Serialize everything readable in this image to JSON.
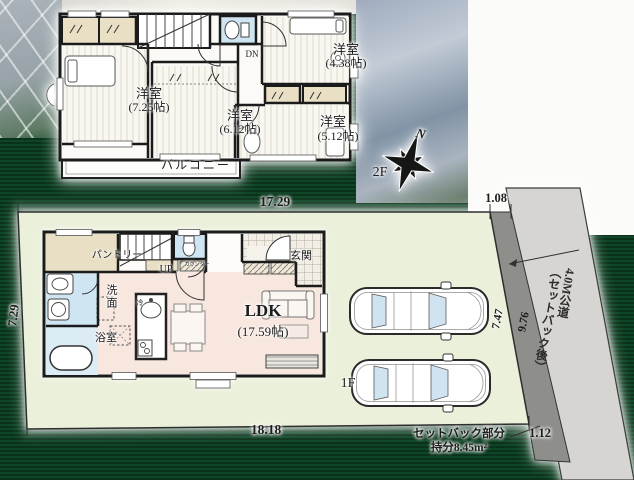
{
  "watermark": "HOUSE",
  "compass": {
    "north_label": "N"
  },
  "floor2": {
    "floor_label": "2F",
    "stair_label": "DN",
    "balcony_label": "バルコニー",
    "room_a_name": "洋室",
    "room_a_size": "(7.25帖)",
    "room_b_name": "洋室",
    "room_b_size": "(6.12帖)",
    "room_c_name": "洋室",
    "room_c_size": "(4.38帖)",
    "room_d_name": "洋室",
    "room_d_size": "(5.12帖)"
  },
  "floor1": {
    "floor_label": "1F",
    "stair_label": "UP",
    "pantry_label": "パントリー",
    "counter_label": "カウンター",
    "entrance_label": "玄関",
    "washroom_label": "洗面",
    "bath_label": "浴室",
    "fridge_label": "冷",
    "ldk_name": "LDK",
    "ldk_size": "(17.59帖)"
  },
  "site": {
    "dim_top_width": "17.29",
    "dim_top_setback": "1.08",
    "dim_left_depth": "7.29",
    "dim_bottom_width": "18.18",
    "dim_bottom_setback": "1.12",
    "dim_parking_depth": "7.47",
    "dim_road_depth": "9.76",
    "road_name": "4.0M公道",
    "road_note": "（セットバック後）",
    "setback_line1": "セットバック部分",
    "setback_line2": "持分8.45m²"
  },
  "colors": {
    "background_green": "#0d3b21",
    "site_green": "#eaf0da",
    "road_gray": "#d6d5d1",
    "setback_gray": "#8e8e8a",
    "ldk_pink": "#f8e7df",
    "water_blue": "#cfe6f2",
    "closet_beige": "#e9dfc4",
    "wall_black": "#1b1b1b"
  }
}
